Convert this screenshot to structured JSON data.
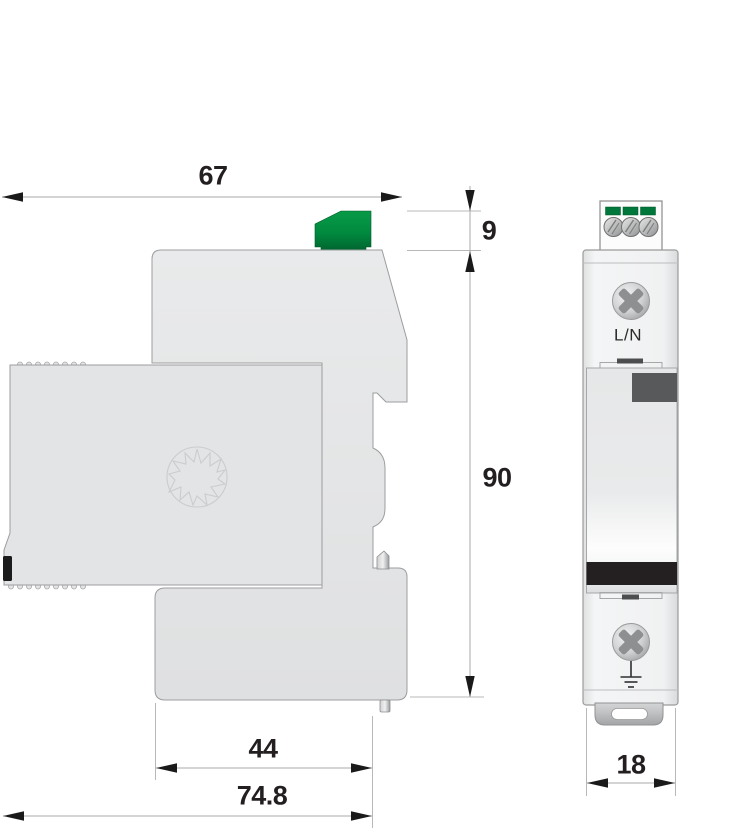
{
  "dimensions": {
    "overall_depth_top": "67",
    "connector_height": "9",
    "body_height": "90",
    "base_depth": "44",
    "overall_depth_bottom": "74.8",
    "module_width": "18"
  },
  "front_view": {
    "terminal_label": "L/N"
  },
  "icons": {
    "screw_top": "phillips-screw",
    "screw_bottom": "phillips-screw",
    "earth": "ground-symbol",
    "logo": "starburst-logo"
  },
  "colors": {
    "device_body_gray": "#e3e4e5",
    "connector_green": "#008a3f",
    "indicator_window_dark": "#57595b",
    "status_bar_black": "#242021",
    "dimension_text": "#231f20",
    "dimension_line": "#a8a8a8",
    "extension_line": "#b8b8b8"
  }
}
